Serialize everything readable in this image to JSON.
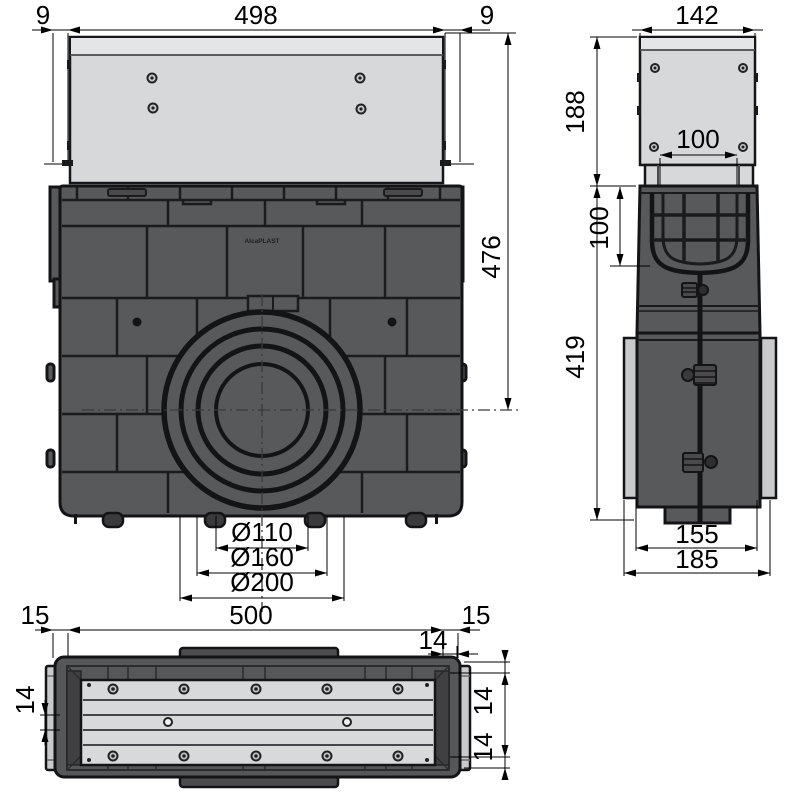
{
  "drawing_title": "drainage-gully-technical-drawing",
  "brand": {
    "logo": "AlcaPLAST"
  },
  "dims": {
    "front": {
      "offset_left": "9",
      "top_width": "498",
      "offset_right": "9",
      "height_to_axis": "476",
      "outlet_small": "Ø110",
      "outlet_mid": "Ø160",
      "outlet_large": "Ø200"
    },
    "side": {
      "top_width": "142",
      "extension_height": "188",
      "channel_width": "100",
      "channel_depth": "100",
      "body_height": "419",
      "base_width": "155",
      "overall_depth": "185"
    },
    "bottom": {
      "offset_left": "15",
      "body_length": "500",
      "offset_right": "15",
      "corner_offset": "14",
      "rib_width": "14",
      "wall_top": "14",
      "wall_bottom": "14"
    }
  },
  "colors": {
    "body_dark": "#58595b",
    "panel_light": "#d7d8d9",
    "cap_light": "#c9cacb",
    "outline": "#141416",
    "dimension": "#000000",
    "background": "#ffffff"
  }
}
